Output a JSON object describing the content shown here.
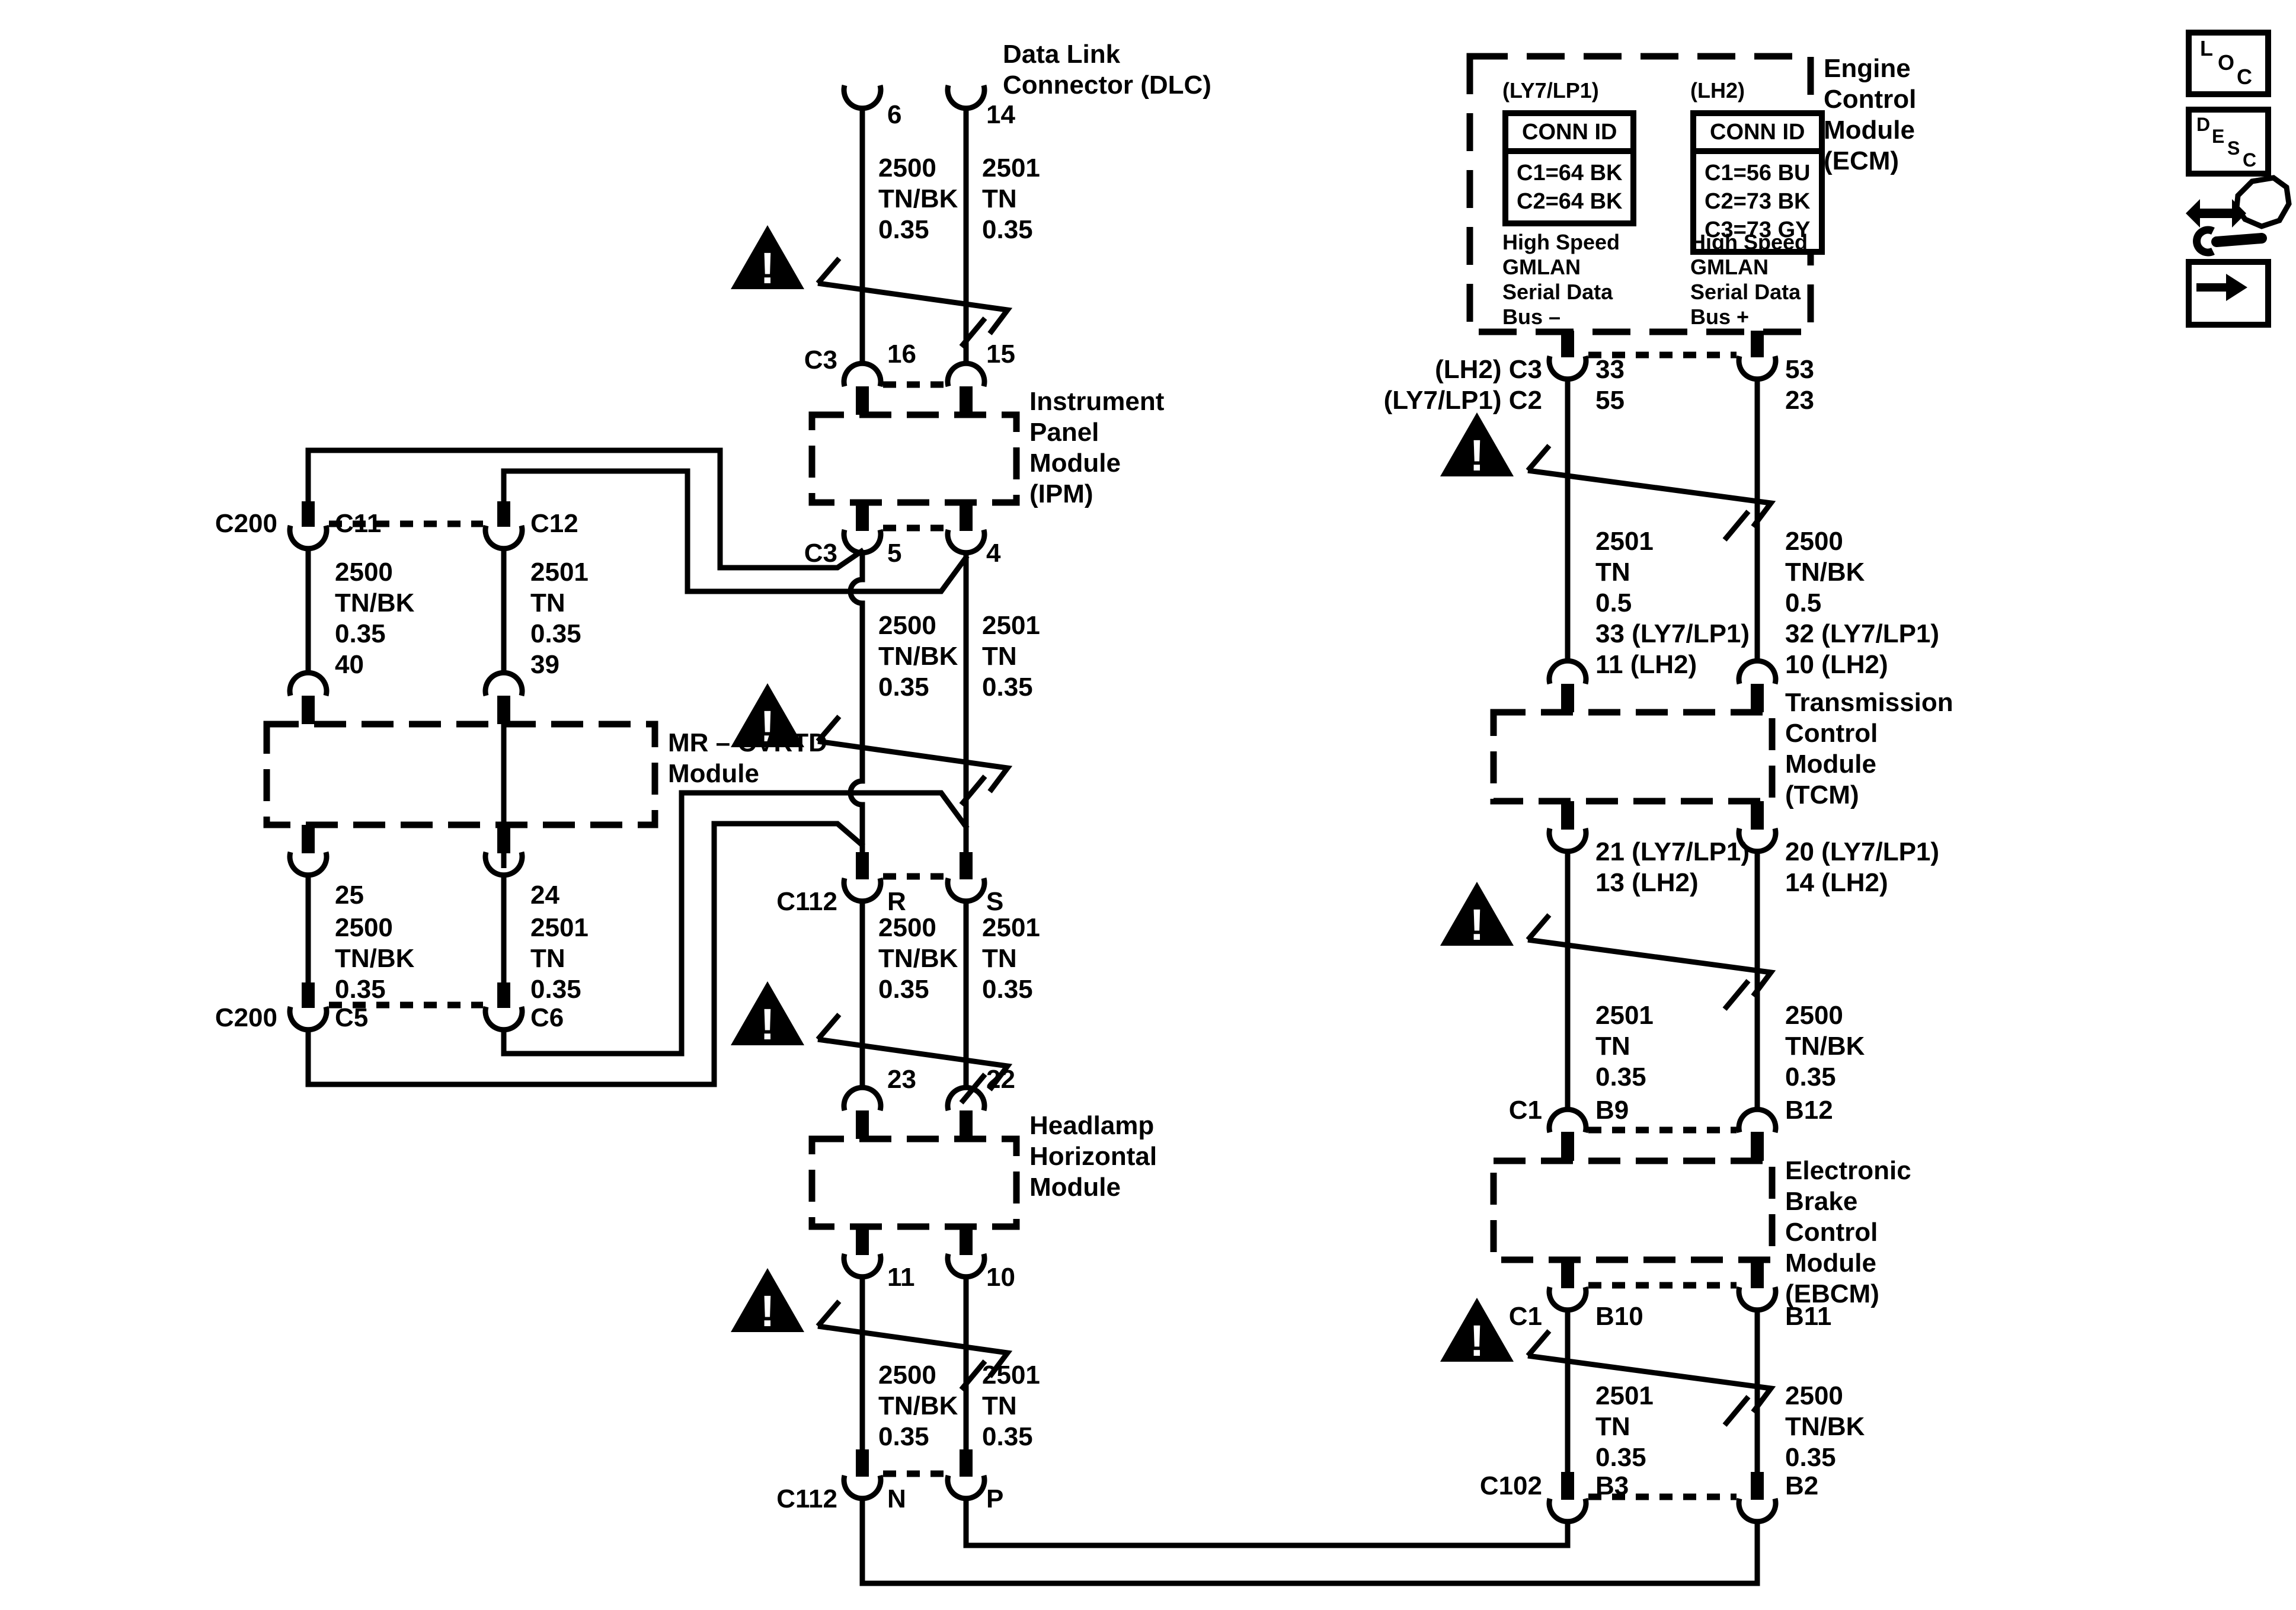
{
  "titles": {
    "dlc": "Data Link\nConnector (DLC)",
    "ipm": "Instrument\nPanel\nModule\n(IPM)",
    "mr": "MR – CVRTD\nModule",
    "headlamp": "Headlamp\nHorizontal\nModule",
    "ecm": "Engine\nControl\nModule\n(ECM)",
    "tcm": "Transmission\nControl\nModule\n(TCM)",
    "ebcm": "Electronic\nBrake\nControl\nModule\n(EBCM)"
  },
  "ecm": {
    "variant_left": "(LY7/LP1)",
    "variant_right": "(LH2)",
    "conn_id": "CONN ID",
    "left_rows": "C1=64 BK\nC2=64 BK",
    "right_rows": "C1=56 BU\nC2=73 BK\nC3=73 GY",
    "bus_minus": "High Speed\nGMLAN\nSerial Data\nBus –",
    "bus_plus": "High Speed\nGMLAN\nSerial Data\nBus +"
  },
  "wire": {
    "w2500_035": "2500\nTN/BK\n0.35",
    "w2501_035": "2501\nTN\n0.35",
    "w2500_05": "2500\nTN/BK\n0.5",
    "w2501_05": "2501\nTN\n0.5"
  },
  "conn": {
    "c3": "C3",
    "c112": "C112",
    "c200": "C200",
    "c1": "C1",
    "c102": "C102"
  },
  "pin": {
    "p6": "6",
    "p14": "14",
    "p16": "16",
    "p15": "15",
    "p5": "5",
    "p4": "4",
    "r": "R",
    "s": "S",
    "p23": "23",
    "p22": "22",
    "p11": "11",
    "p10": "10",
    "n": "N",
    "p": "P",
    "c11": "C11",
    "c12": "C12",
    "p40": "40",
    "p39": "39",
    "p25": "25",
    "p24": "24",
    "c5": "C5",
    "c6": "C6",
    "p33": "33",
    "p55": "55",
    "p53": "53",
    "p23r": "23",
    "lh2c3": "(LH2) C3",
    "ly7c2": "(LY7/LP1) C2",
    "p33ly7": "33 (LY7/LP1)",
    "p11lh2": "11 (LH2)",
    "p32ly7": "32 (LY7/LP1)",
    "p10lh2": "10 (LH2)",
    "p21ly7": "21 (LY7/LP1)",
    "p13lh2": "13 (LH2)",
    "p20ly7": "20 (LY7/LP1)",
    "p14lh2": "14 (LH2)",
    "b9": "B9",
    "b12": "B12",
    "b10": "B10",
    "b11": "B11",
    "b3": "B3",
    "b2": "B2"
  },
  "icons": {
    "warning": "!",
    "loc": [
      "L",
      "O",
      "C"
    ],
    "desc": [
      "D",
      "E",
      "S",
      "C"
    ]
  }
}
